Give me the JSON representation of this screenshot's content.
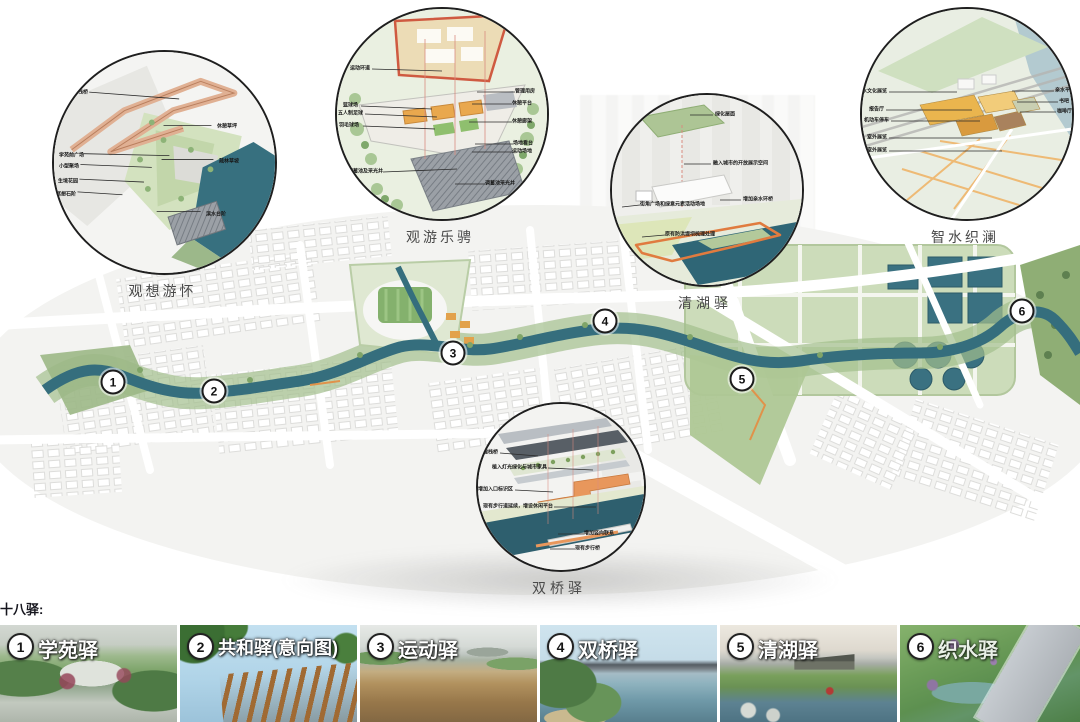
{
  "page": {
    "section_title": "十八驿:"
  },
  "colors": {
    "river": "#356E7D",
    "greenway": "#A3BF8D",
    "accent_orange": "#E0924A",
    "callout_ring": "#1F1F1F",
    "caption_text": "#4A4A4A",
    "dark_text": "#16161E"
  },
  "callouts": [
    {
      "title": "观想游怀",
      "labels": [
        "星河栈桥",
        "休憩草坪",
        "学苑前广场",
        "疏林草坡",
        "小型聚场",
        "生境花园",
        "冥想石阶",
        "滨水台阶"
      ]
    },
    {
      "title": "观游乐骋",
      "labels": [
        "运动环道",
        "管理用房",
        "休憩平台",
        "篮球场",
        "五人制足球",
        "羽毛球场",
        "休憩廊架",
        "场地看台",
        "运动场地",
        "调蓄池及采光井",
        "调蓄池采光井"
      ]
    },
    {
      "title": "清湖驿",
      "labels": [
        "绿化屋面",
        "融入城市的开放展示空间",
        "增加亲水环桥",
        "街角广场和绿意元素活动场地",
        "原有防洪堤坝梳理处理"
      ]
    },
    {
      "title": "智水织澜",
      "labels": [
        "水文化展览",
        "报告厅",
        "机动车停车",
        "室外展览",
        "室外展览",
        "亲水平台",
        "书吧",
        "咖啡厅"
      ]
    },
    {
      "title": "双桥驿",
      "labels": [
        "新建栈桥",
        "植入灯光绿化与城市家具",
        "增加入口标识区",
        "现有步行道延续，增设休闲平台",
        "增加竖向联系",
        "现有步行桥"
      ]
    }
  ],
  "map": {
    "markers": [
      "1",
      "2",
      "3",
      "4",
      "5",
      "6"
    ]
  },
  "stations": [
    {
      "num": "1",
      "name": "学苑驿"
    },
    {
      "num": "2",
      "name": "共和驿(意向图)"
    },
    {
      "num": "3",
      "name": "运动驿"
    },
    {
      "num": "4",
      "name": "双桥驿"
    },
    {
      "num": "5",
      "name": "清湖驿"
    },
    {
      "num": "6",
      "name": "织水驿"
    }
  ]
}
